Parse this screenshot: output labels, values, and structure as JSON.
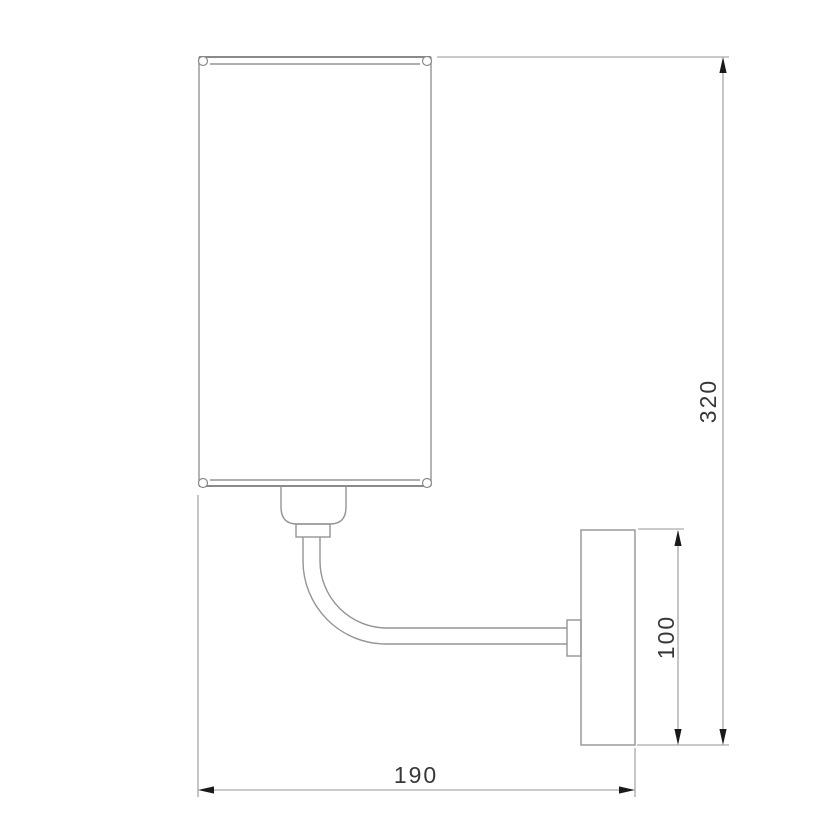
{
  "drawing": {
    "background_color": "#ffffff",
    "line_color": "#949494",
    "arrow_color": "#1a1a1a",
    "label_color": "#383838",
    "dimensions": {
      "overall_height": {
        "value": "320",
        "orientation": "vertical"
      },
      "plate_height": {
        "value": "100",
        "orientation": "vertical"
      },
      "overall_depth": {
        "value": "190",
        "orientation": "horizontal"
      }
    }
  }
}
